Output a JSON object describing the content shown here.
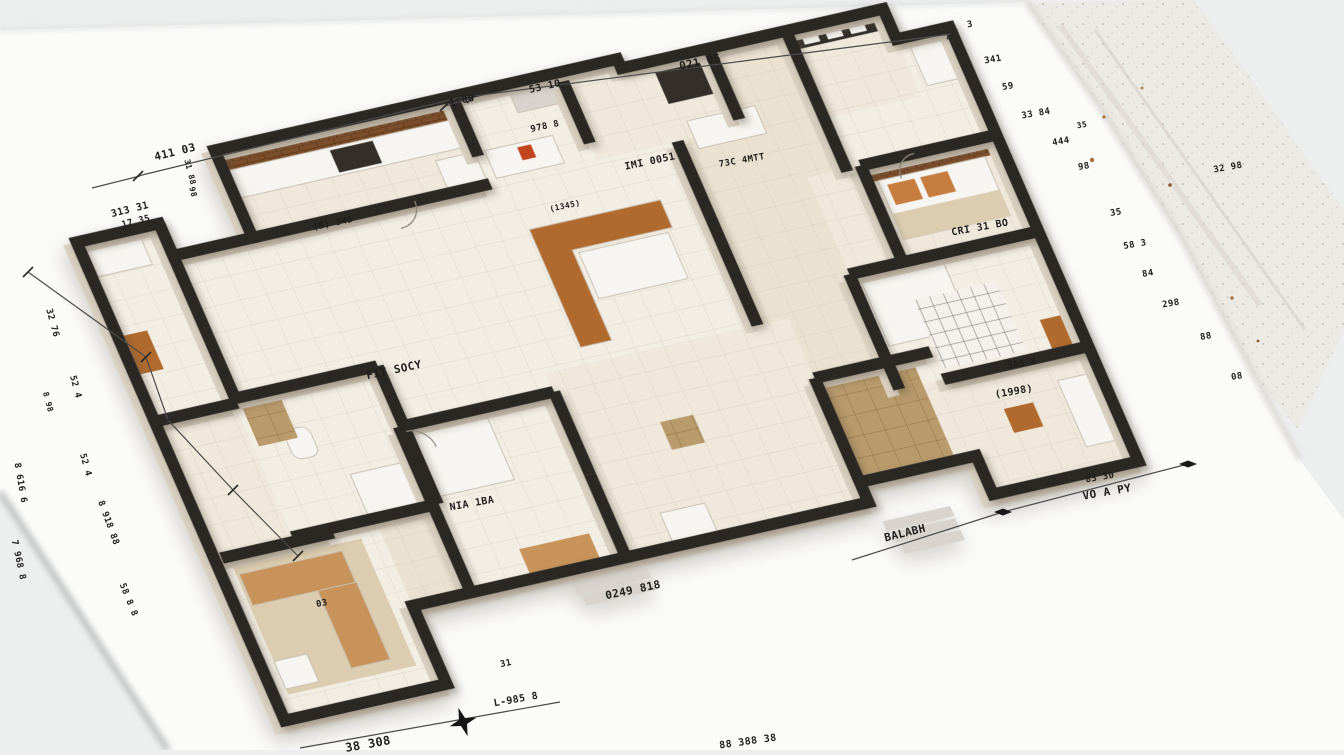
{
  "palette": {
    "desk": "#edefef",
    "sheet": "#fbfbfa",
    "wall": "#2b2824",
    "wallSide": "#d9d0c1",
    "floorA": "#efe8db",
    "floorB": "#f3eee4",
    "floorC": "#eae1d1",
    "wood": "#b06a2e",
    "lightwood": "#c8935a",
    "white": "#f7f5f1",
    "dark": "#332e29",
    "red": "#c2451f",
    "orange": "#c77d3f",
    "rug": "#dccdb0",
    "gray": "#d8d4cd",
    "ink": "#1d1d1d",
    "dimline": "#4a4a4a"
  },
  "plan": {
    "rooms": [
      {
        "name": "left-room",
        "x": -22,
        "y": 95,
        "w": 85,
        "h": 195,
        "fill": "floorB"
      },
      {
        "name": "kitchen",
        "x": 145,
        "y": 35,
        "w": 245,
        "h": 95,
        "fill": "floorA"
      },
      {
        "name": "dresser-room",
        "x": 390,
        "y": 35,
        "w": 110,
        "h": 95,
        "fill": "floorB"
      },
      {
        "name": "art-room",
        "x": 500,
        "y": 45,
        "w": 150,
        "h": 85,
        "fill": "floorA"
      },
      {
        "name": "top-hall",
        "x": 650,
        "y": 45,
        "w": 80,
        "h": 85,
        "fill": "floorC"
      },
      {
        "name": "balcony",
        "x": 730,
        "y": 45,
        "w": 100,
        "h": 95,
        "fill": "floorA"
      },
      {
        "name": "utility",
        "x": 830,
        "y": 78,
        "w": 55,
        "h": 100,
        "fill": "floorB"
      },
      {
        "name": "living",
        "x": 63,
        "y": 130,
        "w": 520,
        "h": 200,
        "fill": "floorB"
      },
      {
        "name": "corridor",
        "x": 583,
        "y": 130,
        "w": 147,
        "h": 265,
        "fill": "floorC"
      },
      {
        "name": "right-hall",
        "x": 730,
        "y": 140,
        "w": 155,
        "h": 60,
        "fill": "floorB"
      },
      {
        "name": "bedroom-nook",
        "x": 690,
        "y": 195,
        "w": 55,
        "h": 105,
        "fill": "floorA"
      },
      {
        "name": "bedroom-east",
        "x": 745,
        "y": 195,
        "w": 140,
        "h": 105,
        "fill": "floorA"
      },
      {
        "name": "bathroom",
        "x": 60,
        "y": 285,
        "w": 150,
        "h": 150,
        "fill": "floorB"
      },
      {
        "name": "lower-left-hall",
        "x": -22,
        "y": 290,
        "w": 82,
        "h": 150,
        "fill": "floorA"
      },
      {
        "name": "bedroom-center",
        "x": 205,
        "y": 330,
        "w": 160,
        "h": 200,
        "fill": "floorB"
      },
      {
        "name": "mid-south-hall",
        "x": 365,
        "y": 330,
        "w": 250,
        "h": 200,
        "fill": "floorA"
      },
      {
        "name": "tatami-hall",
        "x": 615,
        "y": 395,
        "w": 120,
        "h": 113,
        "fill": "floorC"
      },
      {
        "name": "bedroom-southeast",
        "x": 690,
        "y": 300,
        "w": 195,
        "h": 125,
        "fill": "floorB"
      },
      {
        "name": "southeast-ext",
        "x": 690,
        "y": 425,
        "w": 45,
        "h": 83,
        "fill": "floorA"
      },
      {
        "name": "bedroom-corner",
        "x": 735,
        "y": 425,
        "w": 150,
        "h": 125,
        "fill": "floorA"
      },
      {
        "name": "south-corridor",
        "x": 60,
        "y": 435,
        "w": 145,
        "h": 95,
        "fill": "floorC"
      },
      {
        "name": "bedroom-southwest",
        "x": -15,
        "y": 440,
        "w": 160,
        "h": 175,
        "fill": "floorB"
      }
    ],
    "walls": {
      "outer": "M-22,95 L63,95 L63,130 L145,130 L145,35 L560,35 L560,45 L830,45 L830,78 L885,78 L885,550 L735,550 L735,508 L615,508 L615,530 L145,530 L145,615 L-22,615 Z",
      "inner": [
        "M145,130 L390,130",
        "M390,35 L390,100",
        "M500,45 L500,112",
        "M650,45 L650,122",
        "M730,45 L730,198",
        "M745,195 L885,195",
        "M745,195 L745,300",
        "M690,300 L885,300",
        "M690,300 L690,425",
        "M735,425 L885,425",
        "M63,95 L63,290",
        "M-22,290 L63,290",
        "M60,285 L210,285",
        "M210,285 L210,435",
        "M60,435 L210,435",
        "M205,350 L365,350",
        "M365,350 L365,440",
        "M205,350 L205,530",
        "M583,130 L583,330",
        "M615,395 L735,395",
        "M615,395 L615,508",
        "M-15,440 L100,440",
        "M365,440 L365,530"
      ]
    },
    "doors": [
      "M312,130 a24,24 0 0 1 -24,24",
      "M800,195 a22,22 0 0 0 -22,22",
      "M210,356 a22,22 0 0 1 22,22"
    ],
    "furniture": [
      {
        "name": "kitchen-backsplash",
        "x": 150,
        "y": 38,
        "w": 235,
        "h": 20,
        "fill": "@brick"
      },
      {
        "name": "kitchen-counter",
        "x": 150,
        "y": 58,
        "w": 235,
        "h": 30,
        "fill": "white",
        "stroke": 1
      },
      {
        "name": "kitchen-stove",
        "x": 253,
        "y": 61,
        "w": 44,
        "h": 24,
        "fill": "dark"
      },
      {
        "name": "lounge-chairs",
        "x": 348,
        "y": 95,
        "w": 40,
        "h": 30,
        "fill": "white",
        "stroke": 1
      },
      {
        "name": "dresser",
        "x": 398,
        "y": 96,
        "w": 70,
        "h": 30,
        "fill": "white",
        "stroke": 1
      },
      {
        "name": "red-vase",
        "x": 430,
        "y": 100,
        "w": 14,
        "h": 14,
        "fill": "red"
      },
      {
        "name": "wall-art-b",
        "x": 445,
        "y": 40,
        "w": 55,
        "h": 26,
        "fill": "gray",
        "stroke": 1
      },
      {
        "name": "wall-art-c",
        "x": 590,
        "y": 55,
        "w": 55,
        "h": 36,
        "fill": "dark"
      },
      {
        "name": "sofa-c",
        "x": 600,
        "y": 112,
        "w": 70,
        "h": 30,
        "fill": "white",
        "stroke": 1
      },
      {
        "name": "window-frame",
        "x": 732,
        "y": 48,
        "w": 96,
        "h": 18,
        "fill": "dark"
      },
      {
        "name": "window-pane-1",
        "x": 742,
        "y": 51,
        "w": 16,
        "h": 12,
        "fill": "white"
      },
      {
        "name": "window-pane-2",
        "x": 766,
        "y": 51,
        "w": 16,
        "h": 12,
        "fill": "white"
      },
      {
        "name": "window-pane-3",
        "x": 790,
        "y": 51,
        "w": 16,
        "h": 12,
        "fill": "white"
      },
      {
        "name": "fridge",
        "x": 840,
        "y": 85,
        "w": 36,
        "h": 46,
        "fill": "white",
        "stroke": 1
      },
      {
        "name": "headboard-brick",
        "x": 748,
        "y": 198,
        "w": 130,
        "h": 16,
        "fill": "@brick"
      },
      {
        "name": "bed-east",
        "x": 755,
        "y": 214,
        "w": 110,
        "h": 64,
        "fill": "white",
        "stroke": 1
      },
      {
        "name": "pillow-east-1",
        "x": 762,
        "y": 220,
        "w": 28,
        "h": 22,
        "fill": "orange"
      },
      {
        "name": "pillow-east-2",
        "x": 796,
        "y": 220,
        "w": 28,
        "h": 22,
        "fill": "orange"
      },
      {
        "name": "blanket-east",
        "x": 755,
        "y": 250,
        "w": 110,
        "h": 28,
        "fill": "rug"
      },
      {
        "name": "kitchen-island",
        "path": "M408,184 h135 v30 h-103 v98 h-32 Z",
        "fill": "wood",
        "stroke": 1
      },
      {
        "name": "island-sofa",
        "x": 445,
        "y": 218,
        "w": 92,
        "h": 50,
        "fill": "white",
        "stroke": 1
      },
      {
        "name": "bed-southeast",
        "x": 698,
        "y": 308,
        "w": 85,
        "h": 72,
        "fill": "white",
        "stroke": 1
      },
      {
        "name": "grid-rug",
        "x": 740,
        "y": 340,
        "w": 85,
        "h": 75,
        "fill": "@gridrug"
      },
      {
        "name": "cabinet-se",
        "x": 850,
        "y": 388,
        "w": 32,
        "h": 32,
        "fill": "wood"
      },
      {
        "name": "stool",
        "x": 780,
        "y": 468,
        "w": 30,
        "h": 26,
        "fill": "wood"
      },
      {
        "name": "bed-corner",
        "x": 842,
        "y": 452,
        "w": 42,
        "h": 72,
        "fill": "white",
        "stroke": 1
      },
      {
        "name": "tatami-rug",
        "x": 620,
        "y": 400,
        "w": 94,
        "h": 102,
        "fill": "@tatami"
      },
      {
        "name": "bed-center",
        "x": 212,
        "y": 356,
        "w": 80,
        "h": 72,
        "fill": "white",
        "stroke": 1
      },
      {
        "name": "slat-decor",
        "x": 268,
        "y": 498,
        "w": 72,
        "h": 26,
        "fill": "lightwood"
      },
      {
        "name": "wardrobe",
        "x": 415,
        "y": 494,
        "w": 46,
        "h": 38,
        "fill": "white",
        "stroke": 1
      },
      {
        "name": "wicker-basket",
        "x": 452,
        "y": 404,
        "w": 34,
        "h": 30,
        "fill": "@tatami"
      },
      {
        "name": "rug-southwest",
        "x": -8,
        "y": 452,
        "w": 132,
        "h": 138,
        "fill": "rug"
      },
      {
        "name": "bench-top",
        "x": -5,
        "y": 460,
        "w": 106,
        "h": 34,
        "fill": "lightwood",
        "stroke": 1
      },
      {
        "name": "bench-side",
        "x": 62,
        "y": 494,
        "w": 40,
        "h": 84,
        "fill": "lightwood",
        "stroke": 1
      },
      {
        "name": "ottoman",
        "x": -8,
        "y": 554,
        "w": 34,
        "h": 30,
        "fill": "white",
        "stroke": 1
      },
      {
        "name": "bathtub",
        "x": 140,
        "y": 386,
        "w": 52,
        "h": 50,
        "fill": "white",
        "stroke": 1
      },
      {
        "name": "toilet",
        "x": 94,
        "y": 328,
        "w": 26,
        "h": 32,
        "rx": 9,
        "fill": "white",
        "stroke": 1
      },
      {
        "name": "bath-shelf",
        "x": 66,
        "y": 294,
        "w": 40,
        "h": 44,
        "fill": "@tatami"
      },
      {
        "name": "sofa-left",
        "x": -16,
        "y": 106,
        "w": 56,
        "h": 28,
        "fill": "white",
        "stroke": 1
      },
      {
        "name": "cabinet-left",
        "x": -16,
        "y": 198,
        "w": 24,
        "h": 42,
        "fill": "wood"
      },
      {
        "name": "step",
        "x": 300,
        "y": 532,
        "w": 80,
        "h": 11,
        "fill": "gray"
      },
      {
        "name": "step",
        "x": 304,
        "y": 545,
        "w": 76,
        "h": 11,
        "fill": "gray"
      },
      {
        "name": "step",
        "x": 308,
        "y": 558,
        "w": 72,
        "h": 11,
        "fill": "gray"
      },
      {
        "name": "step",
        "x": 620,
        "y": 552,
        "w": 70,
        "h": 11,
        "fill": "gray"
      },
      {
        "name": "step",
        "x": 624,
        "y": 565,
        "w": 66,
        "h": 11,
        "fill": "gray"
      },
      {
        "name": "step",
        "x": 628,
        "y": 578,
        "w": 62,
        "h": 11,
        "fill": "gray"
      }
    ]
  },
  "dimension_lines": [
    {
      "points": [
        [
          92,
          188
        ],
        [
          140,
          176
        ]
      ],
      "marks": "none"
    },
    {
      "points": [
        [
          138,
          176
        ],
        [
          458,
          98
        ],
        [
          952,
          34
        ]
      ],
      "marks": "slash"
    },
    {
      "points": [
        [
          445,
          106
        ],
        [
          472,
          98
        ]
      ],
      "marks": "slash"
    },
    {
      "points": [
        [
          28,
          272
        ],
        [
          146,
          357
        ],
        [
          168,
          420
        ],
        [
          233,
          490
        ],
        [
          298,
          556
        ]
      ],
      "marks": "slash"
    },
    {
      "points": [
        [
          300,
          748
        ],
        [
          560,
          702
        ]
      ],
      "marks": "none"
    },
    {
      "points": [
        [
          852,
          560
        ],
        [
          1003,
          512
        ],
        [
          1188,
          464
        ]
      ],
      "marks": "diamond"
    }
  ],
  "compass": {
    "x": 463,
    "y": 722,
    "rot": -18
  },
  "annotations": [
    {
      "text": "411 03",
      "x": 175,
      "y": 152,
      "rot": -14,
      "size": 11
    },
    {
      "text": "1 00",
      "x": 462,
      "y": 101,
      "rot": -13,
      "size": 10
    },
    {
      "text": "53 10",
      "x": 545,
      "y": 87,
      "rot": -13,
      "size": 10
    },
    {
      "text": "021 05",
      "x": 700,
      "y": 62,
      "rot": -12,
      "size": 11
    },
    {
      "text": "313 31",
      "x": 130,
      "y": 210,
      "rot": -14,
      "size": 10
    },
    {
      "text": "17 35",
      "x": 136,
      "y": 222,
      "rot": -14,
      "size": 9
    },
    {
      "text": "31 88",
      "x": 190,
      "y": 172,
      "rot": 76,
      "size": 8
    },
    {
      "text": "98",
      "x": 193,
      "y": 192,
      "rot": 76,
      "size": 8
    },
    {
      "text": "978 8",
      "x": 545,
      "y": 127,
      "rot": -12,
      "size": 9
    },
    {
      "text": "IMI 0051",
      "x": 650,
      "y": 162,
      "rot": -12,
      "size": 10
    },
    {
      "text": "73C 4MTT",
      "x": 742,
      "y": 161,
      "rot": -10,
      "size": 9
    },
    {
      "text": "(B) 345",
      "x": 333,
      "y": 224,
      "rot": -12,
      "size": 9
    },
    {
      "text": "(1345)",
      "x": 565,
      "y": 206,
      "rot": -12,
      "size": 8
    },
    {
      "text": "CRI 31 BO",
      "x": 980,
      "y": 228,
      "rot": -10,
      "size": 10
    },
    {
      "text": "FIT SOCY",
      "x": 394,
      "y": 370,
      "rot": -12,
      "size": 11
    },
    {
      "text": "505 8",
      "x": 1022,
      "y": 364,
      "rot": -10,
      "size": 9
    },
    {
      "text": "(1998)",
      "x": 1014,
      "y": 392,
      "rot": -10,
      "size": 10
    },
    {
      "text": "NIA 1BA",
      "x": 472,
      "y": 504,
      "rot": -10,
      "size": 10
    },
    {
      "text": "03",
      "x": 322,
      "y": 604,
      "rot": -12,
      "size": 9
    },
    {
      "text": "0249 818",
      "x": 633,
      "y": 590,
      "rot": -12,
      "size": 11
    },
    {
      "text": "31",
      "x": 506,
      "y": 664,
      "rot": -12,
      "size": 9
    },
    {
      "text": "L-985 8",
      "x": 516,
      "y": 700,
      "rot": -10,
      "size": 10
    },
    {
      "text": "38 308",
      "x": 368,
      "y": 744,
      "rot": -10,
      "size": 12
    },
    {
      "text": "88 388 38",
      "x": 748,
      "y": 742,
      "rot": -8,
      "size": 10
    },
    {
      "text": "BALABH",
      "x": 905,
      "y": 533,
      "rot": -14,
      "size": 11
    },
    {
      "text": "83 30",
      "x": 1100,
      "y": 478,
      "rot": -10,
      "size": 9
    },
    {
      "text": "VO A PY",
      "x": 1107,
      "y": 492,
      "rot": -10,
      "size": 11
    },
    {
      "text": "32 76",
      "x": 52,
      "y": 323,
      "rot": 75,
      "size": 9
    },
    {
      "text": "52 4",
      "x": 75,
      "y": 387,
      "rot": 75,
      "size": 9
    },
    {
      "text": "8 98",
      "x": 48,
      "y": 402,
      "rot": 75,
      "size": 8
    },
    {
      "text": "52 4",
      "x": 85,
      "y": 465,
      "rot": 75,
      "size": 9
    },
    {
      "text": "8 616 6",
      "x": 20,
      "y": 483,
      "rot": 80,
      "size": 9
    },
    {
      "text": "8 918 88",
      "x": 108,
      "y": 523,
      "rot": 70,
      "size": 9
    },
    {
      "text": "7 968 8",
      "x": 18,
      "y": 560,
      "rot": 78,
      "size": 9
    },
    {
      "text": "58 8 8",
      "x": 128,
      "y": 600,
      "rot": 68,
      "size": 9
    },
    {
      "text": "3",
      "x": 970,
      "y": 25,
      "rot": -10,
      "size": 9
    },
    {
      "text": "341",
      "x": 993,
      "y": 60,
      "rot": -10,
      "size": 9
    },
    {
      "text": "59",
      "x": 1008,
      "y": 87,
      "rot": -10,
      "size": 9
    },
    {
      "text": "33 84",
      "x": 1036,
      "y": 114,
      "rot": -10,
      "size": 9
    },
    {
      "text": "35",
      "x": 1082,
      "y": 125,
      "rot": -10,
      "size": 8
    },
    {
      "text": "444",
      "x": 1061,
      "y": 142,
      "rot": -10,
      "size": 9
    },
    {
      "text": "98",
      "x": 1084,
      "y": 167,
      "rot": -10,
      "size": 9
    },
    {
      "text": "32 98",
      "x": 1228,
      "y": 168,
      "rot": -10,
      "size": 9
    },
    {
      "text": "35",
      "x": 1116,
      "y": 213,
      "rot": -10,
      "size": 9
    },
    {
      "text": "58 3",
      "x": 1135,
      "y": 245,
      "rot": -10,
      "size": 9
    },
    {
      "text": "84",
      "x": 1148,
      "y": 274,
      "rot": -10,
      "size": 9
    },
    {
      "text": "298",
      "x": 1171,
      "y": 304,
      "rot": -10,
      "size": 9
    },
    {
      "text": "88",
      "x": 1206,
      "y": 337,
      "rot": -10,
      "size": 9
    },
    {
      "text": "08",
      "x": 1237,
      "y": 377,
      "rot": -10,
      "size": 9
    }
  ]
}
